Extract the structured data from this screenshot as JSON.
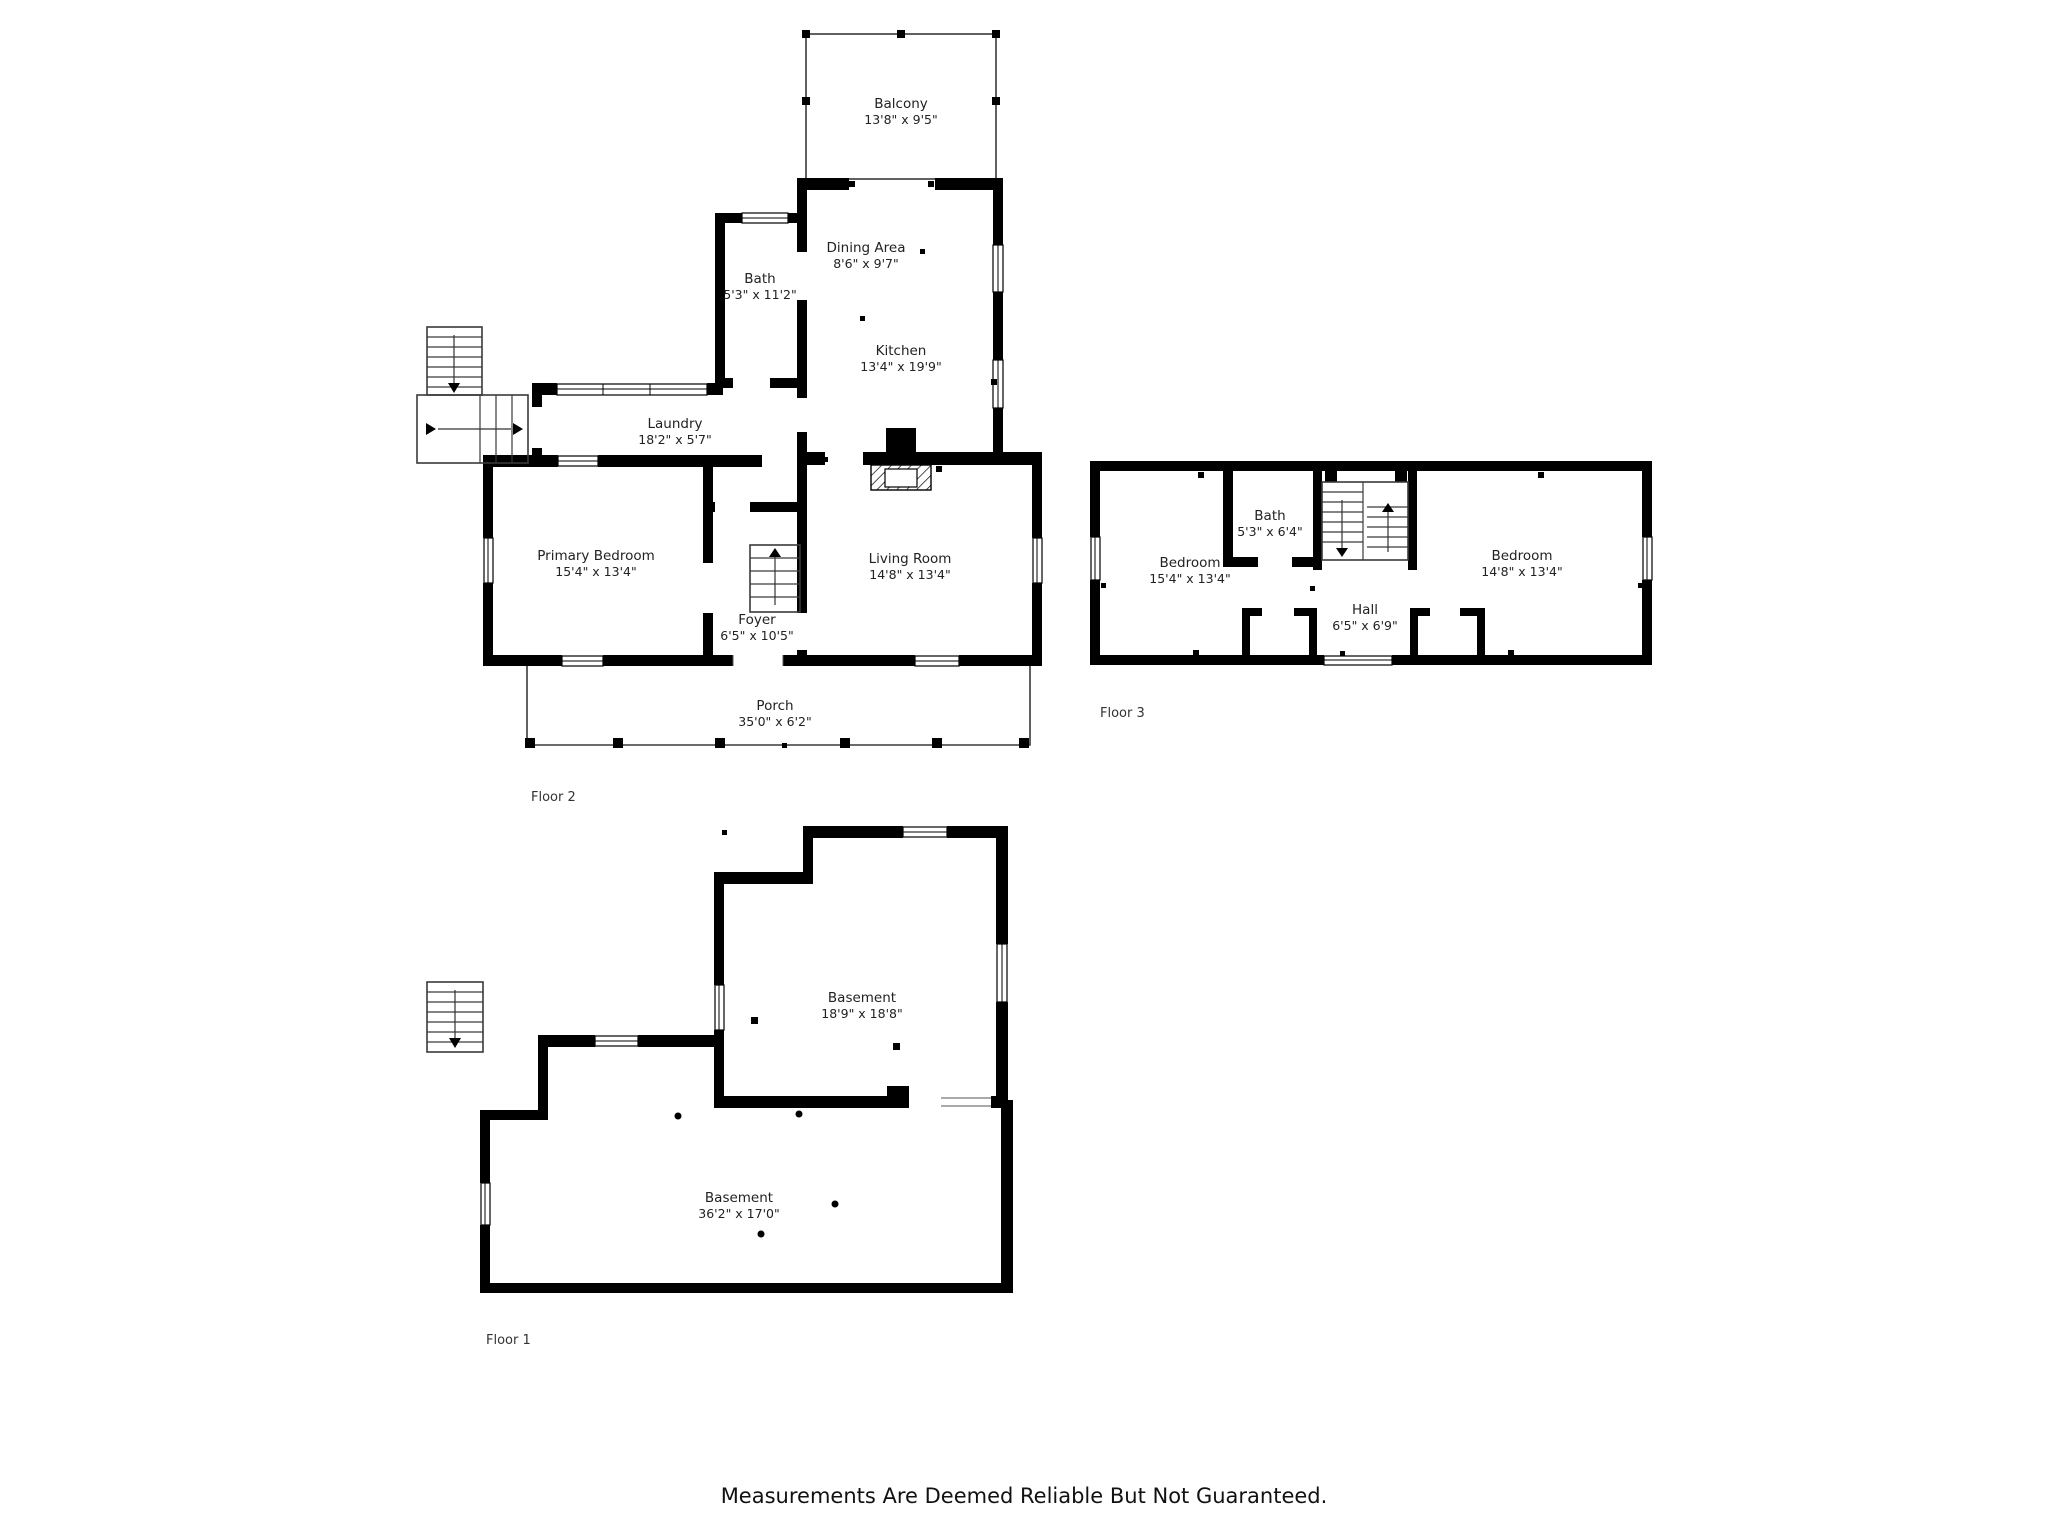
{
  "page": {
    "background": "#ffffff",
    "footer_note": "Measurements Are Deemed Reliable But Not Guaranteed."
  },
  "colors": {
    "wall": "#000000",
    "text": "#222222",
    "accent_line": "#3a3a3a"
  },
  "floors": {
    "floor2": {
      "label": "Floor 2",
      "rooms": {
        "balcony": {
          "name": "Balcony",
          "dims": "13'8\" x 9'5\""
        },
        "dining": {
          "name": "Dining Area",
          "dims": "8'6\" x 9'7\""
        },
        "bath": {
          "name": "Bath",
          "dims": "5'3\" x 11'2\""
        },
        "kitchen": {
          "name": "Kitchen",
          "dims": "13'4\" x 19'9\""
        },
        "laundry": {
          "name": "Laundry",
          "dims": "18'2\" x 5'7\""
        },
        "primary_bedroom": {
          "name": "Primary Bedroom",
          "dims": "15'4\" x 13'4\""
        },
        "foyer": {
          "name": "Foyer",
          "dims": "6'5\" x 10'5\""
        },
        "living_room": {
          "name": "Living Room",
          "dims": "14'8\" x 13'4\""
        },
        "porch": {
          "name": "Porch",
          "dims": "35'0\" x 6'2\""
        }
      }
    },
    "floor3": {
      "label": "Floor 3",
      "rooms": {
        "bedroom_left": {
          "name": "Bedroom",
          "dims": "15'4\" x 13'4\""
        },
        "bath": {
          "name": "Bath",
          "dims": "5'3\" x 6'4\""
        },
        "hall": {
          "name": "Hall",
          "dims": "6'5\" x 6'9\""
        },
        "bedroom_right": {
          "name": "Bedroom",
          "dims": "14'8\" x 13'4\""
        }
      }
    },
    "floor1": {
      "label": "Floor 1",
      "rooms": {
        "basement_upper": {
          "name": "Basement",
          "dims": "18'9\" x 18'8\""
        },
        "basement_lower": {
          "name": "Basement",
          "dims": "36'2\" x 17'0\""
        }
      }
    }
  }
}
